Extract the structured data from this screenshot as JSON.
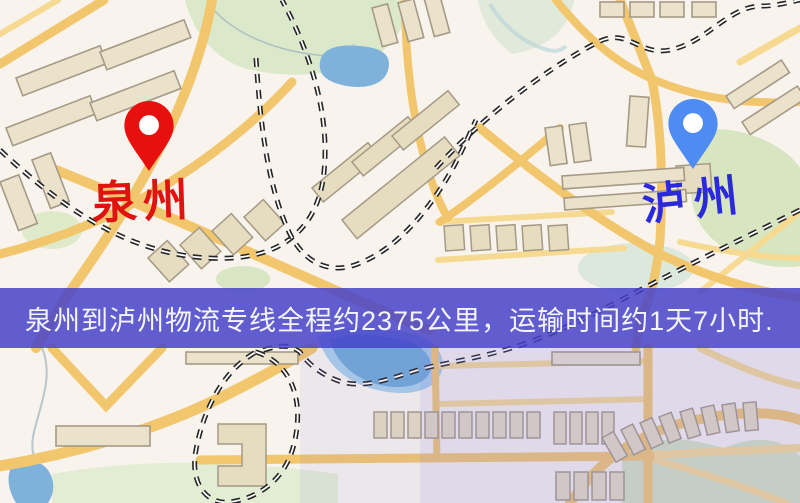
{
  "map": {
    "origin": {
      "label": "泉州",
      "pin_color": "#e8100e",
      "label_color": "#e01310"
    },
    "destination": {
      "label": "泸州",
      "pin_color": "#4f8cf2",
      "label_color": "#2a2ada"
    },
    "colors": {
      "background": "#f8f3ec",
      "road_major": "#f2c66d",
      "road_minor": "#f7da92",
      "park_green": "#d9e7c4",
      "water_blue": "#7fb2da",
      "building_fill": "#ebe2cc",
      "building_stroke": "#a59a86",
      "railway": "#242424"
    }
  },
  "banner": {
    "text": "泉州到泸州物流专线全程约2375公里，运输时间约1天7小时.",
    "background_color": "#4642ca",
    "text_color": "#f4f4fc",
    "distance_text": "约2375公里",
    "duration_text": "约1天7小时"
  }
}
